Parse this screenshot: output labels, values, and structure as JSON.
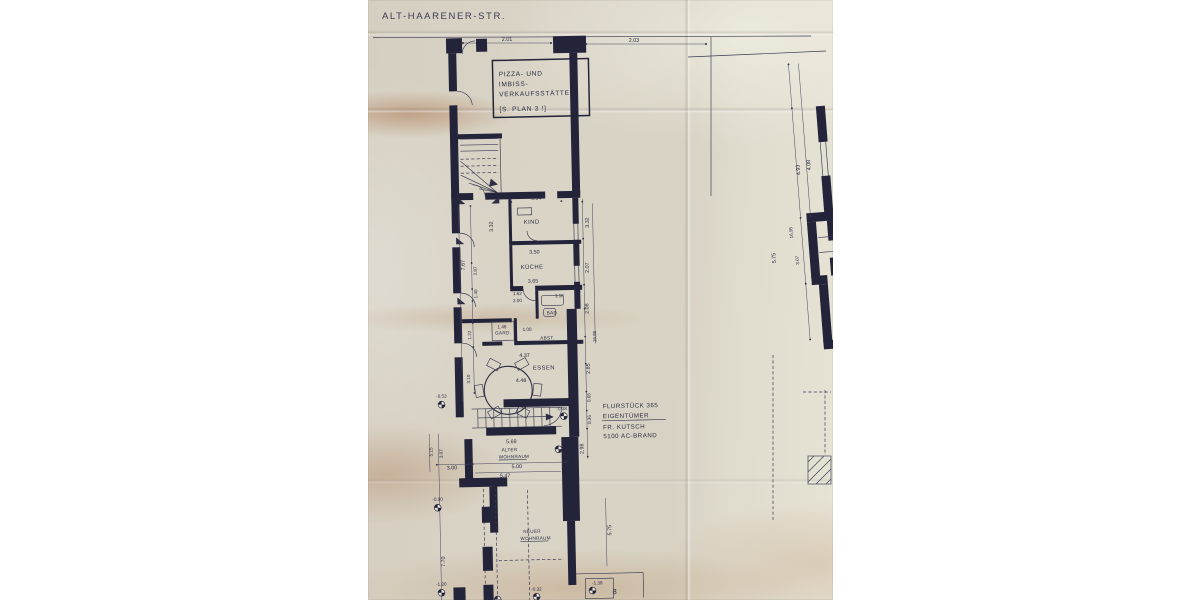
{
  "photo": {
    "ink_color": "#2c2c44",
    "paper_color": "#d9d3c5",
    "street": {
      "label": "ALT-HAARENER-STR."
    },
    "shop_note": {
      "line1": "PIZZA- UND",
      "line2": "IMBISS-",
      "line3": "VERKAUFSSTÄTTE",
      "line4": "[S. PLAN 3 !]"
    },
    "owner_note": {
      "line1": "FLURSTÜCK 365",
      "line2": "EIGENTÜMER",
      "line3": "FR. KUTSCH",
      "line4": "5100 AC-BRAND"
    },
    "rooms": {
      "kind": "KIND",
      "kueche": "KÜCHE",
      "bad": "BAD",
      "abst": "ABST.",
      "gard": "GARD.",
      "essen": "ESSEN",
      "alter_line1": "ALTER",
      "alter_line2": "WOHNRAUM",
      "neuer_line1": "NEUER",
      "neuer_line2": "WOHNRAUM"
    },
    "dims_h": {
      "d201": "2.01",
      "d203": "2.03",
      "d354": "3.54",
      "d350": "3.50",
      "d365": "3.65",
      "d118": "1.18",
      "d162": "1.62",
      "d200": "2.00",
      "d146": "1.46",
      "d100": "1.00",
      "d437": "4.37",
      "d448": "4.48",
      "d569": "5.69",
      "d500": "5.00",
      "d547": "5.47",
      "d300": "3.00",
      "d8": "8"
    },
    "dims_v": {
      "d767": "7.67",
      "d287": "2.87",
      "d140": "1.40",
      "d122": "1.22",
      "d493l": "4.93",
      "d310": "3.10",
      "d332l": "3.32",
      "d332r": "3.32",
      "d207": "2.07",
      "d208": "2.08",
      "d1685": "16.85",
      "d285": "2.85",
      "d065": "0.65",
      "d036": "0.36",
      "d298": "2.98",
      "d575m": "5.75",
      "d515": "5.15",
      "d307l": "3.07",
      "d770": "7.70",
      "d493r": "4.93",
      "d408": "4.08",
      "d1695": "16.95",
      "d575r": "5.75",
      "d307r": "3.07"
    },
    "elevations": {
      "e053": "-0.53",
      "e038": "-0.38",
      "e090": "-0.90",
      "e120": "-1.20",
      "e032": "-0.32",
      "e138": "-1.38"
    }
  }
}
